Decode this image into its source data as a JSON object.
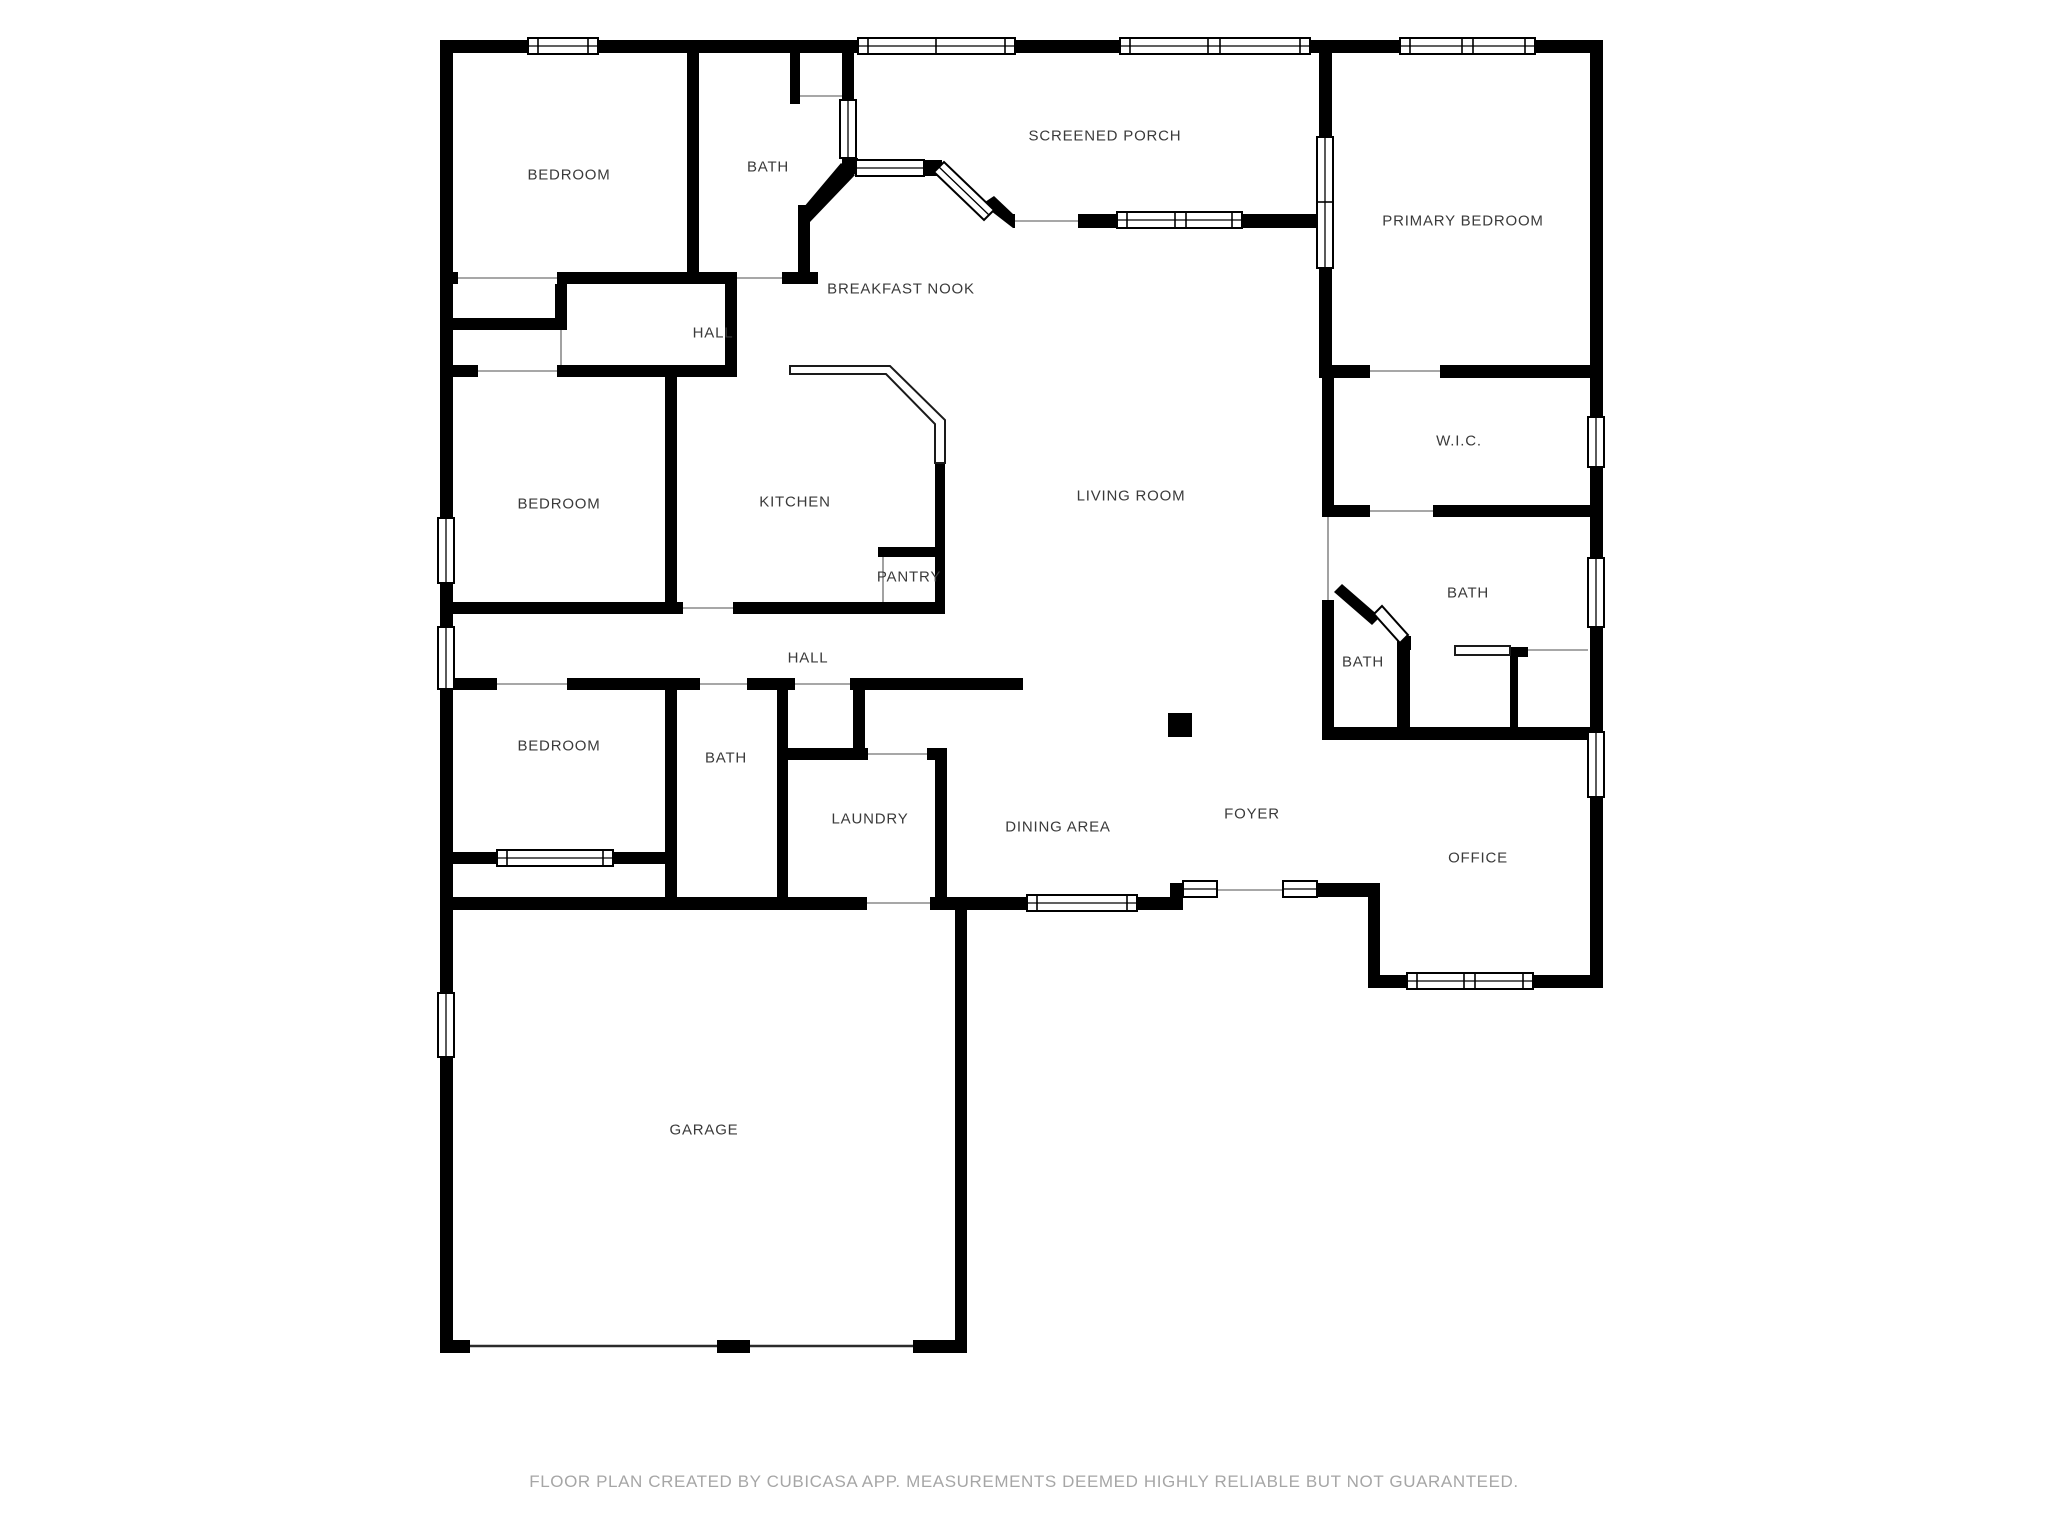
{
  "meta": {
    "background": "#ffffff",
    "wall_color": "#000000",
    "label_color": "#3a3a3a",
    "caption_color": "#a6a6a6"
  },
  "rooms": [
    {
      "id": "bedroom-1",
      "label": "BEDROOM",
      "x": 569,
      "y": 175
    },
    {
      "id": "bath-1",
      "label": "BATH",
      "x": 768,
      "y": 167
    },
    {
      "id": "screened-porch",
      "label": "SCREENED PORCH",
      "x": 1105,
      "y": 136
    },
    {
      "id": "primary-bedroom",
      "label": "PRIMARY BEDROOM",
      "x": 1463,
      "y": 221
    },
    {
      "id": "breakfast-nook",
      "label": "BREAKFAST NOOK",
      "x": 901,
      "y": 289
    },
    {
      "id": "hall-upper",
      "label": "HALL",
      "x": 713,
      "y": 333
    },
    {
      "id": "bedroom-2",
      "label": "BEDROOM",
      "x": 559,
      "y": 504
    },
    {
      "id": "kitchen",
      "label": "KITCHEN",
      "x": 795,
      "y": 502
    },
    {
      "id": "living-room",
      "label": "LIVING ROOM",
      "x": 1131,
      "y": 496
    },
    {
      "id": "wic",
      "label": "W.I.C.",
      "x": 1459,
      "y": 441
    },
    {
      "id": "pantry",
      "label": "PANTRY",
      "x": 909,
      "y": 577
    },
    {
      "id": "bath-primary",
      "label": "BATH",
      "x": 1468,
      "y": 593
    },
    {
      "id": "bath-small",
      "label": "BATH",
      "x": 1363,
      "y": 662
    },
    {
      "id": "hall-lower",
      "label": "HALL",
      "x": 808,
      "y": 658
    },
    {
      "id": "bedroom-3",
      "label": "BEDROOM",
      "x": 559,
      "y": 746
    },
    {
      "id": "bath-2",
      "label": "BATH",
      "x": 726,
      "y": 758
    },
    {
      "id": "laundry",
      "label": "LAUNDRY",
      "x": 870,
      "y": 819
    },
    {
      "id": "dining-area",
      "label": "DINING AREA",
      "x": 1058,
      "y": 827
    },
    {
      "id": "foyer",
      "label": "FOYER",
      "x": 1252,
      "y": 814
    },
    {
      "id": "office",
      "label": "OFFICE",
      "x": 1478,
      "y": 858
    },
    {
      "id": "garage",
      "label": "GARAGE",
      "x": 704,
      "y": 1130
    }
  ],
  "footer": {
    "caption": "FLOOR PLAN CREATED BY CUBICASA APP. MEASUREMENTS DEEMED HIGHLY RELIABLE BUT NOT GUARANTEED."
  }
}
